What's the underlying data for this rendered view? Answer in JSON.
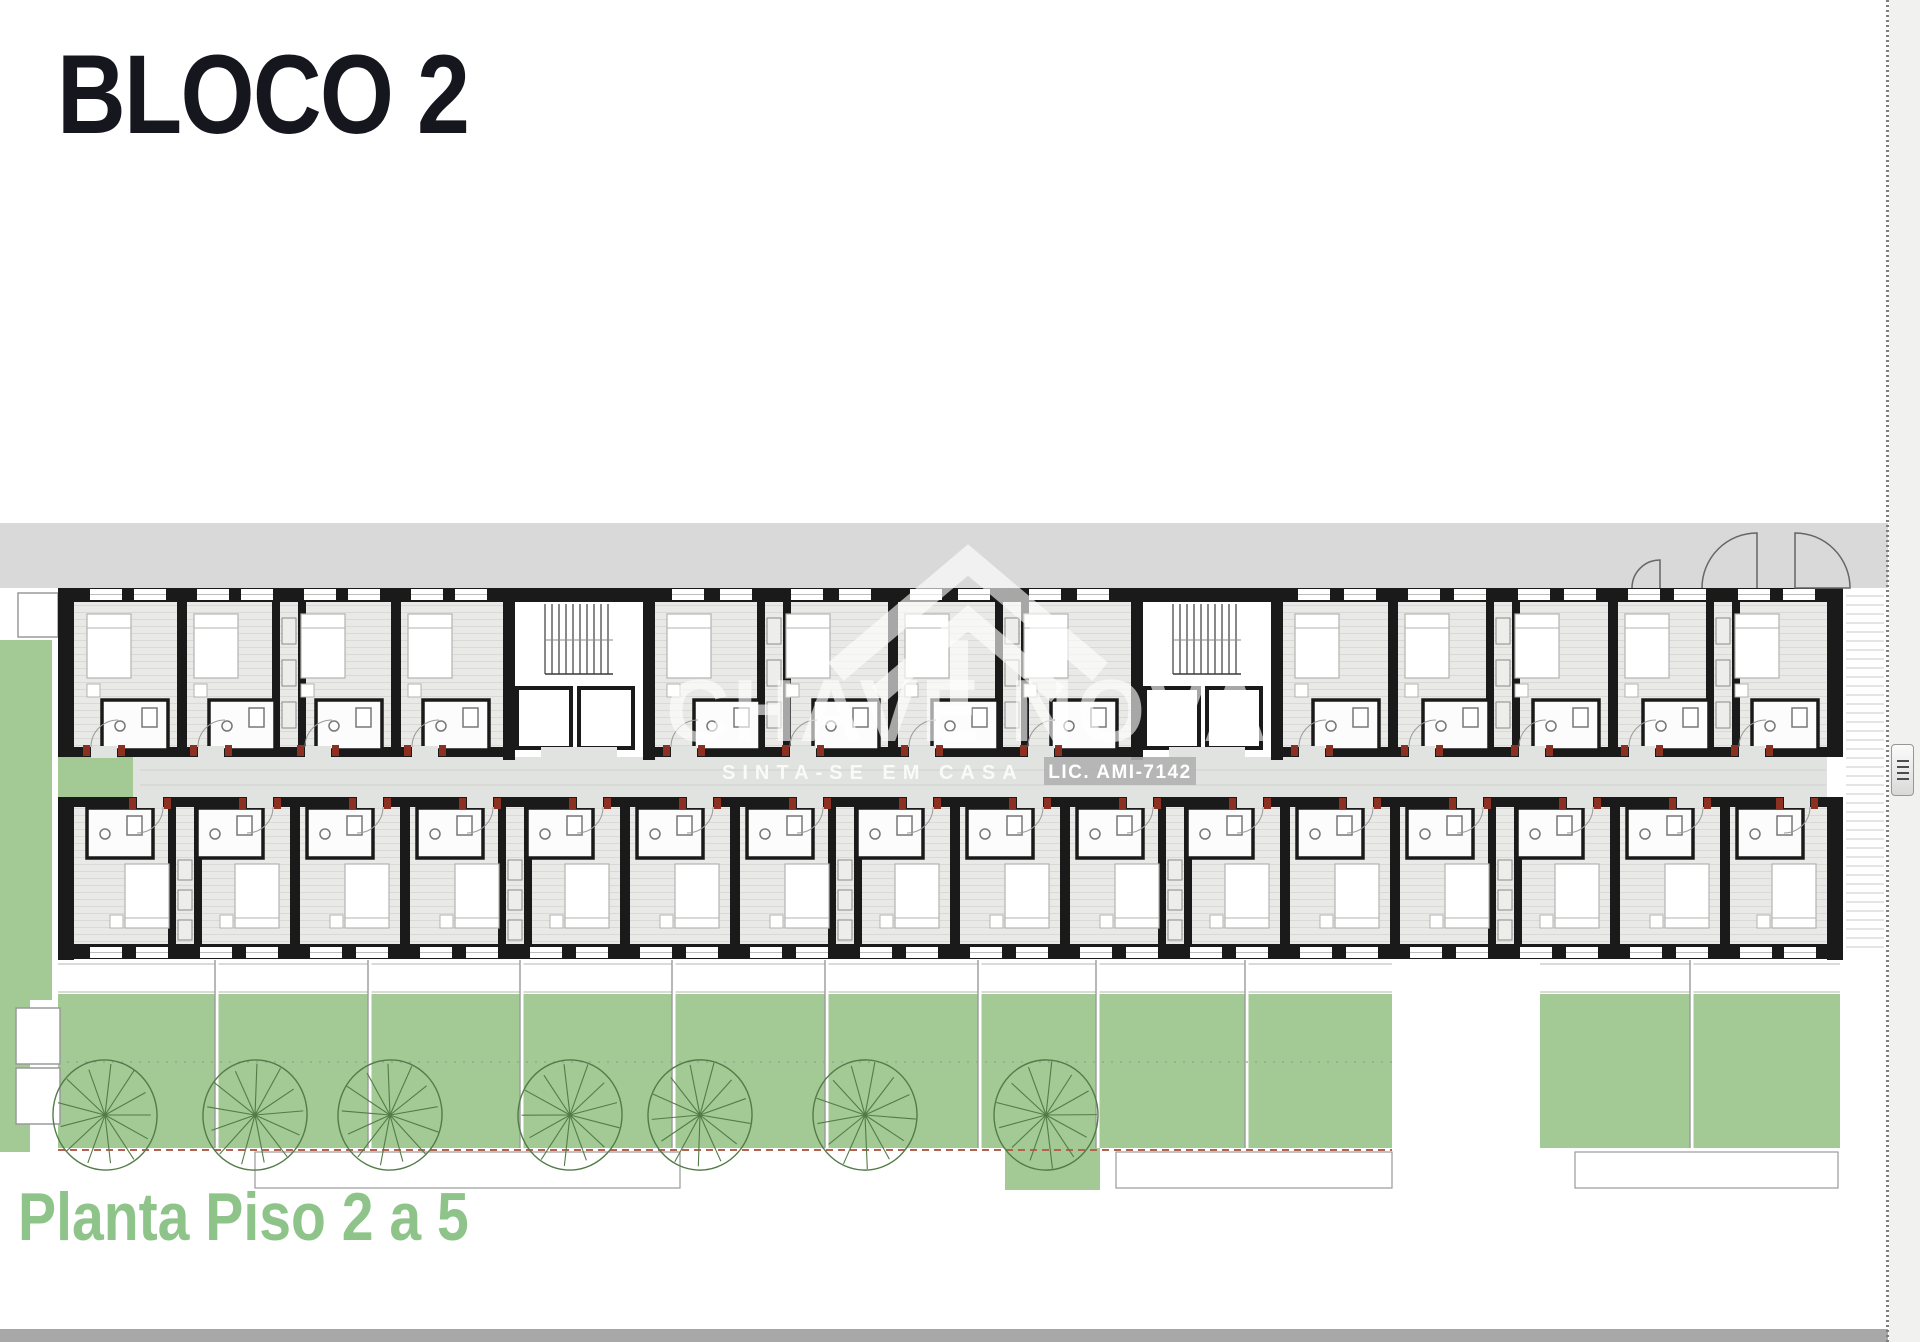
{
  "header": {
    "title": "BLOCO 2"
  },
  "footer": {
    "caption": "Planta Piso 2 a 5"
  },
  "watermark": {
    "brand": "CHAVE NOVA",
    "tagline": "SINTA-SE EM CASA",
    "license": "LIC. AMI-7142"
  },
  "icons": {
    "logo": "house-roof-icon",
    "grip": "drag-handle-grip-icon"
  },
  "colors": {
    "page_bg": "#ffffff",
    "margin_bg": "#f1f1f0",
    "title": "#16161f",
    "caption_green": "#8ec489",
    "road": "#d9d9d9",
    "wall": "#1a1a1a",
    "floor": "#e9e9e7",
    "floor_line": "#d9d9d6",
    "corridor": "#e0e3df",
    "corridor_line": "#cfd2ce",
    "green": "#a3c994",
    "tree": "#527c47",
    "divider_line": "#9a9a9a",
    "path_dash": "#b2644e",
    "door_red": "#8c3122",
    "bar": "#a8a8a8",
    "hatch_right": "#c9c9c9",
    "stair_line": "#3a3a3a",
    "fixture": "#777777",
    "bed_stroke": "#b3b3b0",
    "outline_gray": "#9a9a9a",
    "watermark": "rgba(255,255,255,0.62)",
    "watermark_strong": "rgba(255,255,255,0.82)",
    "lic_box": "rgba(176,176,176,0.9)"
  },
  "plan": {
    "road": {
      "x": 0,
      "y": 523,
      "w": 1888,
      "h": 65
    },
    "building": {
      "x": 58,
      "y": 588,
      "w": 1785,
      "h": 372,
      "wall": 16
    },
    "corridor": {
      "y": 757,
      "h": 40,
      "green_end_w": 75
    },
    "top_units": [
      [
        75,
        182
      ],
      [
        182,
        289
      ],
      [
        289,
        396
      ],
      [
        396,
        503
      ],
      [
        655,
        774
      ],
      [
        774,
        893
      ],
      [
        893,
        1012
      ],
      [
        1012,
        1131
      ],
      [
        1283,
        1393
      ],
      [
        1393,
        1503
      ],
      [
        1503,
        1613
      ],
      [
        1613,
        1723
      ],
      [
        1723,
        1832
      ]
    ],
    "top_dividers": [
      182,
      289,
      396,
      774,
      893,
      1012,
      1393,
      1503,
      1613,
      1723
    ],
    "bottom_edges": [
      75,
      185,
      295,
      405,
      515,
      625,
      735,
      845,
      955,
      1065,
      1175,
      1285,
      1395,
      1505,
      1615,
      1725,
      1832
    ],
    "stairs": [
      [
        503,
        655
      ],
      [
        1131,
        1283
      ]
    ],
    "gardens": {
      "left_strips": [
        [
          0,
          640,
          52,
          360
        ],
        [
          0,
          1000,
          30,
          152
        ]
      ],
      "main": [
        58,
        994,
        1334,
        154
      ],
      "right": [
        1540,
        994,
        300,
        154
      ],
      "below_sq": [
        1005,
        1148,
        95,
        42
      ],
      "dividers": [
        215,
        368,
        520,
        672,
        825,
        978,
        1096,
        1245
      ],
      "right_divider": 1690,
      "planters": [
        [
          16,
          1008,
          44,
          56
        ],
        [
          16,
          1068,
          44,
          56
        ]
      ],
      "top_box": [
        18,
        593,
        40,
        44
      ],
      "terrace_rects": [
        [
          255,
          1152,
          425,
          36
        ],
        [
          1116,
          1152,
          276,
          36
        ],
        [
          1575,
          1152,
          263,
          36
        ]
      ],
      "dotted_line_y": 1062,
      "dash_line_y": 1150
    },
    "trees": {
      "xs": [
        105,
        255,
        390,
        570,
        700,
        865,
        1046
      ],
      "cy": 1115,
      "r": 52
    },
    "exterior_doors": {
      "leaves": [
        1757,
        1795
      ],
      "small_leaf": 1660,
      "wall_y": 588,
      "r": 55
    }
  }
}
